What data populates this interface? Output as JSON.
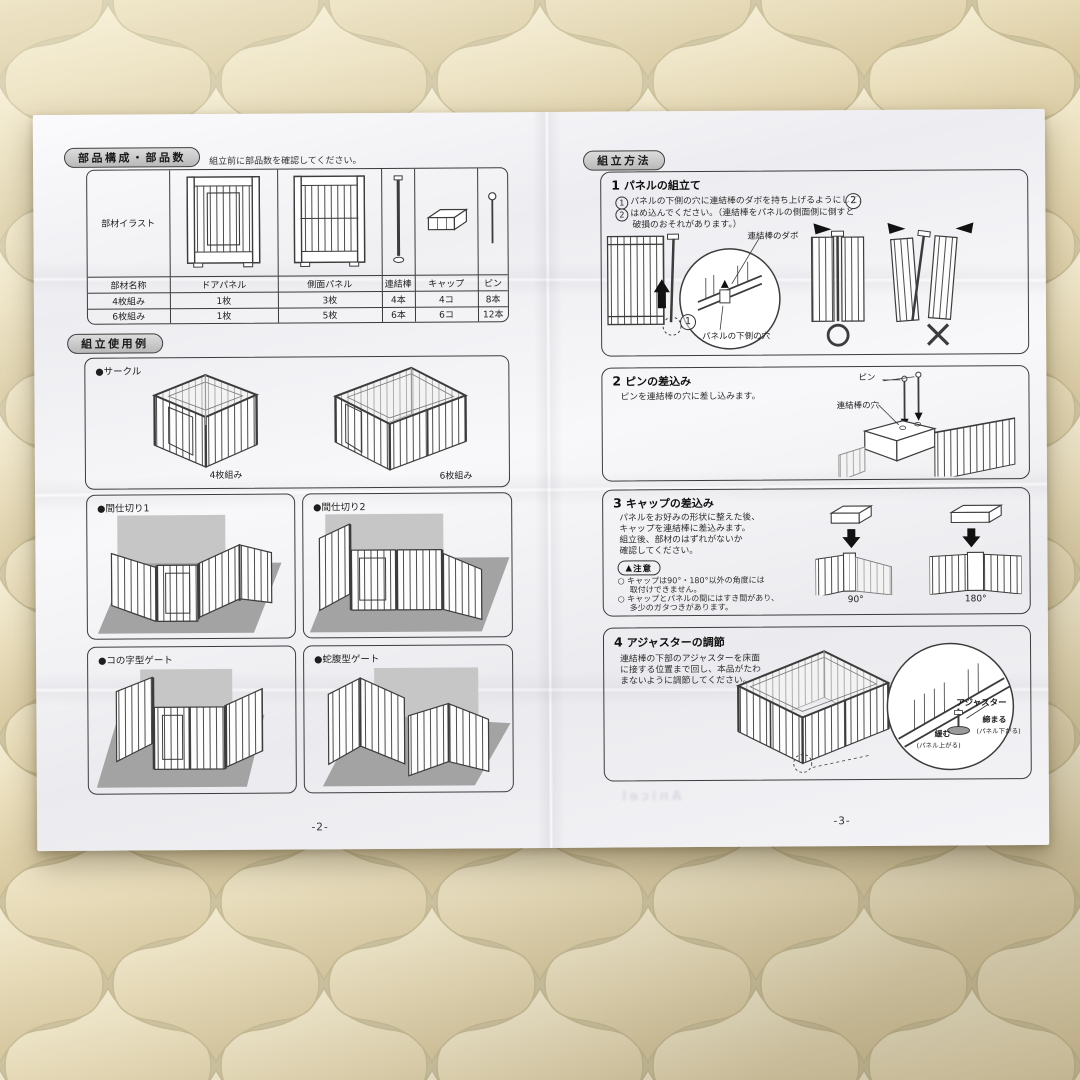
{
  "left": {
    "parts_title": "部品構成・部品数",
    "parts_note": "組立前に部品数を確認してください。",
    "table": {
      "illust_label": "部材イラスト",
      "name_label": "部材名称",
      "cols": [
        "ドアパネル",
        "側面パネル",
        "連結棒",
        "キャップ",
        "ピン"
      ],
      "rows": [
        {
          "label": "4枚組み",
          "values": [
            "1枚",
            "3枚",
            "4本",
            "4コ",
            "8本"
          ]
        },
        {
          "label": "6枚組み",
          "values": [
            "1枚",
            "5枚",
            "6本",
            "6コ",
            "12本"
          ]
        }
      ]
    },
    "examples_title": "組立使用例",
    "examples": {
      "circle": {
        "label": "●サークル",
        "cap4": "4枚組み",
        "cap6": "6枚組み"
      },
      "p1": {
        "label": "●間仕切り1"
      },
      "p2": {
        "label": "●間仕切り2"
      },
      "ug": {
        "label": "●コの字型ゲート"
      },
      "ja": {
        "label": "●蛇腹型ゲート"
      }
    },
    "page_no": "-2-"
  },
  "right": {
    "method_title": "組立方法",
    "step1": {
      "num": "1",
      "title": "パネルの組立て",
      "l1n": "1",
      "l1": "パネルの下側の穴に連結棒のダボを持ち上げるようにして、",
      "l2n": "2",
      "l2": "はめ込んでください。（連結棒をパネルの側面側に倒すと",
      "l3": "破損のおそれがあります。）",
      "lab_dabo": "連結棒のダボ",
      "lab_hole": "パネルの下側の穴",
      "m1": "1",
      "m2": "2"
    },
    "step2": {
      "num": "2",
      "title": "ピンの差込み",
      "l1": "ピンを連結棒の穴に差し込みます。",
      "lab_pin": "ピン",
      "lab_hole": "連結棒の穴"
    },
    "step3": {
      "num": "3",
      "title": "キャップの差込み",
      "l1": "パネルをお好みの形状に整えた後、",
      "l2": "キャップを連結棒に差込みます。",
      "l3": "組立後、部材のはずれがないか",
      "l4": "確認してください。",
      "caution_mark": "▲",
      "caution": "注意",
      "b1a": "○ キャップは90°・180°以外の角度には",
      "b1b": "取付けできません。",
      "b2a": "○ キャップとパネルの間にはすき間があり、",
      "b2b": "多少のガタつきがあります。",
      "deg90": "90°",
      "deg180": "180°"
    },
    "step4": {
      "num": "4",
      "title": "アジャスターの調節",
      "l1": "連結棒の下部のアジャスターを床面",
      "l2": "に接する位置まで回し、本品がたわ",
      "l3": "まないように調節してください。",
      "lab_adj": "アジャスター",
      "lab_tight": "締まる",
      "lab_tight_sub": "(パネル下がる)",
      "lab_loose": "緩む",
      "lab_loose_sub": "(パネル上がる)"
    },
    "page_no": "-3-",
    "show_through": "Anicel"
  }
}
